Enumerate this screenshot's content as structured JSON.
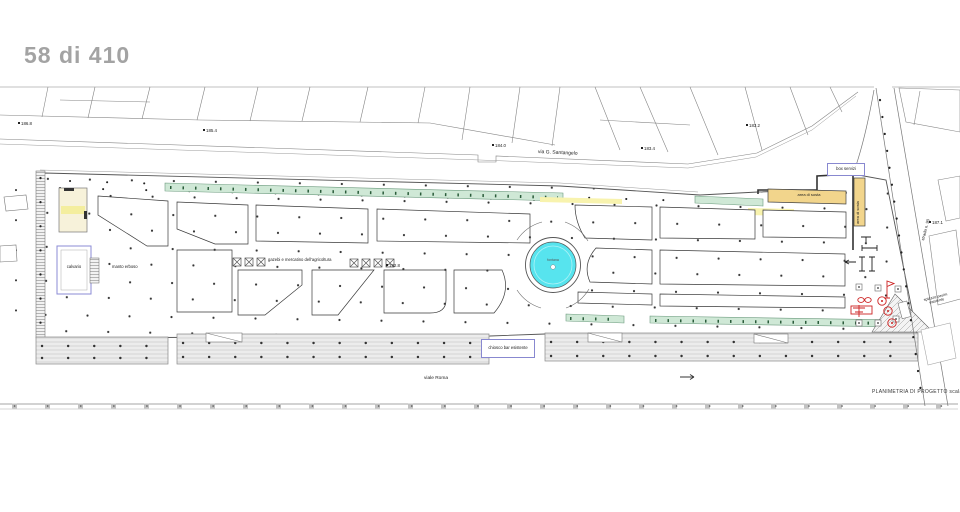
{
  "page_indicator": "58 di 410",
  "plan": {
    "title": "PLANIMETRIA DI PROGETTO scala 1:2",
    "streets": {
      "santangelo": "via G. Santangelo",
      "roma": "viale Roma",
      "side": "strada n. 90"
    },
    "areas": {
      "calvario": "calvario",
      "manto_erboso": "manto erboso",
      "gazebi": "gazebi e mercatino dell'agricoltura",
      "fontana": "fontana",
      "box_servizi": "box servizi",
      "area_sosta_h": "area di sosta",
      "area_sosta_v": "area di sosta",
      "chiosco": "chiosco bar esistente",
      "spiazzo_line1": "spiazzo pavim.",
      "spiazzo_line2": "esistente"
    },
    "elevations": [
      "186.8",
      "185.4",
      "184.0",
      "183.4",
      "183.2",
      "192.8",
      "187.1"
    ],
    "colors": {
      "fountain_water": "#57e4ee",
      "hedge_green": "#cfe8d6",
      "stall_tan": "#f2d58c",
      "highlight_yellow": "#f8f3ae",
      "marker_red": "#cc2222",
      "annotation_blue": "#8888d0",
      "page_number_gray": "#a3a3a3"
    }
  }
}
